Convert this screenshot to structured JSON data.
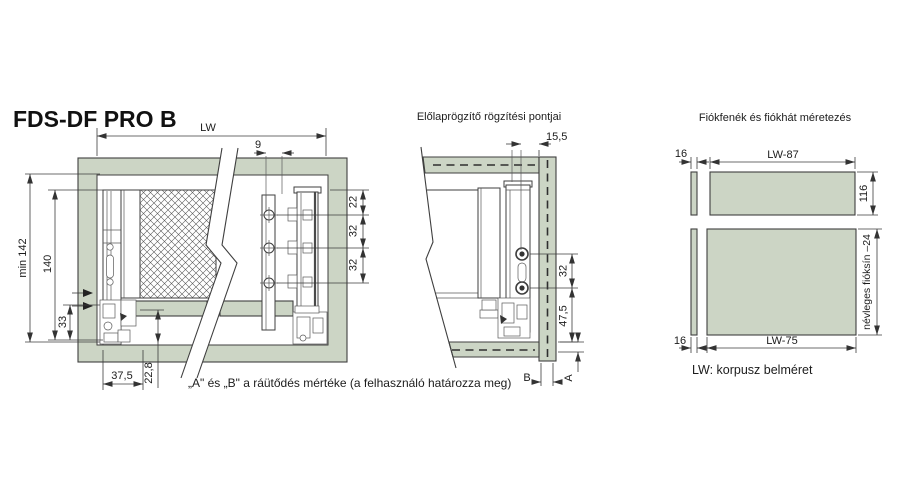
{
  "title": "FDS-DF PRO B",
  "note": "„A\" és „B\" a ráütődés mértéke (a felhasználó határozza meg)",
  "left": {
    "dim_lw": "LW",
    "dim_9": "9",
    "dim_22": "22",
    "dim_32_upper": "32",
    "dim_32_lower": "32",
    "dim_min142": "min 142",
    "dim_140": "140",
    "dim_33": "33",
    "dim_37_5": "37,5",
    "dim_22_8": "22,8"
  },
  "middle": {
    "title": "Előlaprögzítő rögzítési pontjai",
    "dim_15_5": "15,5",
    "dim_32": "32",
    "dim_47_5": "47,5",
    "dim_a": "A",
    "dim_b": "B"
  },
  "right": {
    "title": "Fiókfenék és fiókhát méretezés",
    "dim_16_top": "16",
    "dim_lw_87": "LW-87",
    "dim_116": "116",
    "dim_16_bottom": "16",
    "dim_lw_75": "LW-75",
    "dim_rail": "névleges fióksín –24",
    "legend": "LW: korpusz belméret"
  },
  "colors": {
    "panel": "#ccd5c5",
    "line": "#3f3f3f",
    "text": "#1c1c1c"
  }
}
